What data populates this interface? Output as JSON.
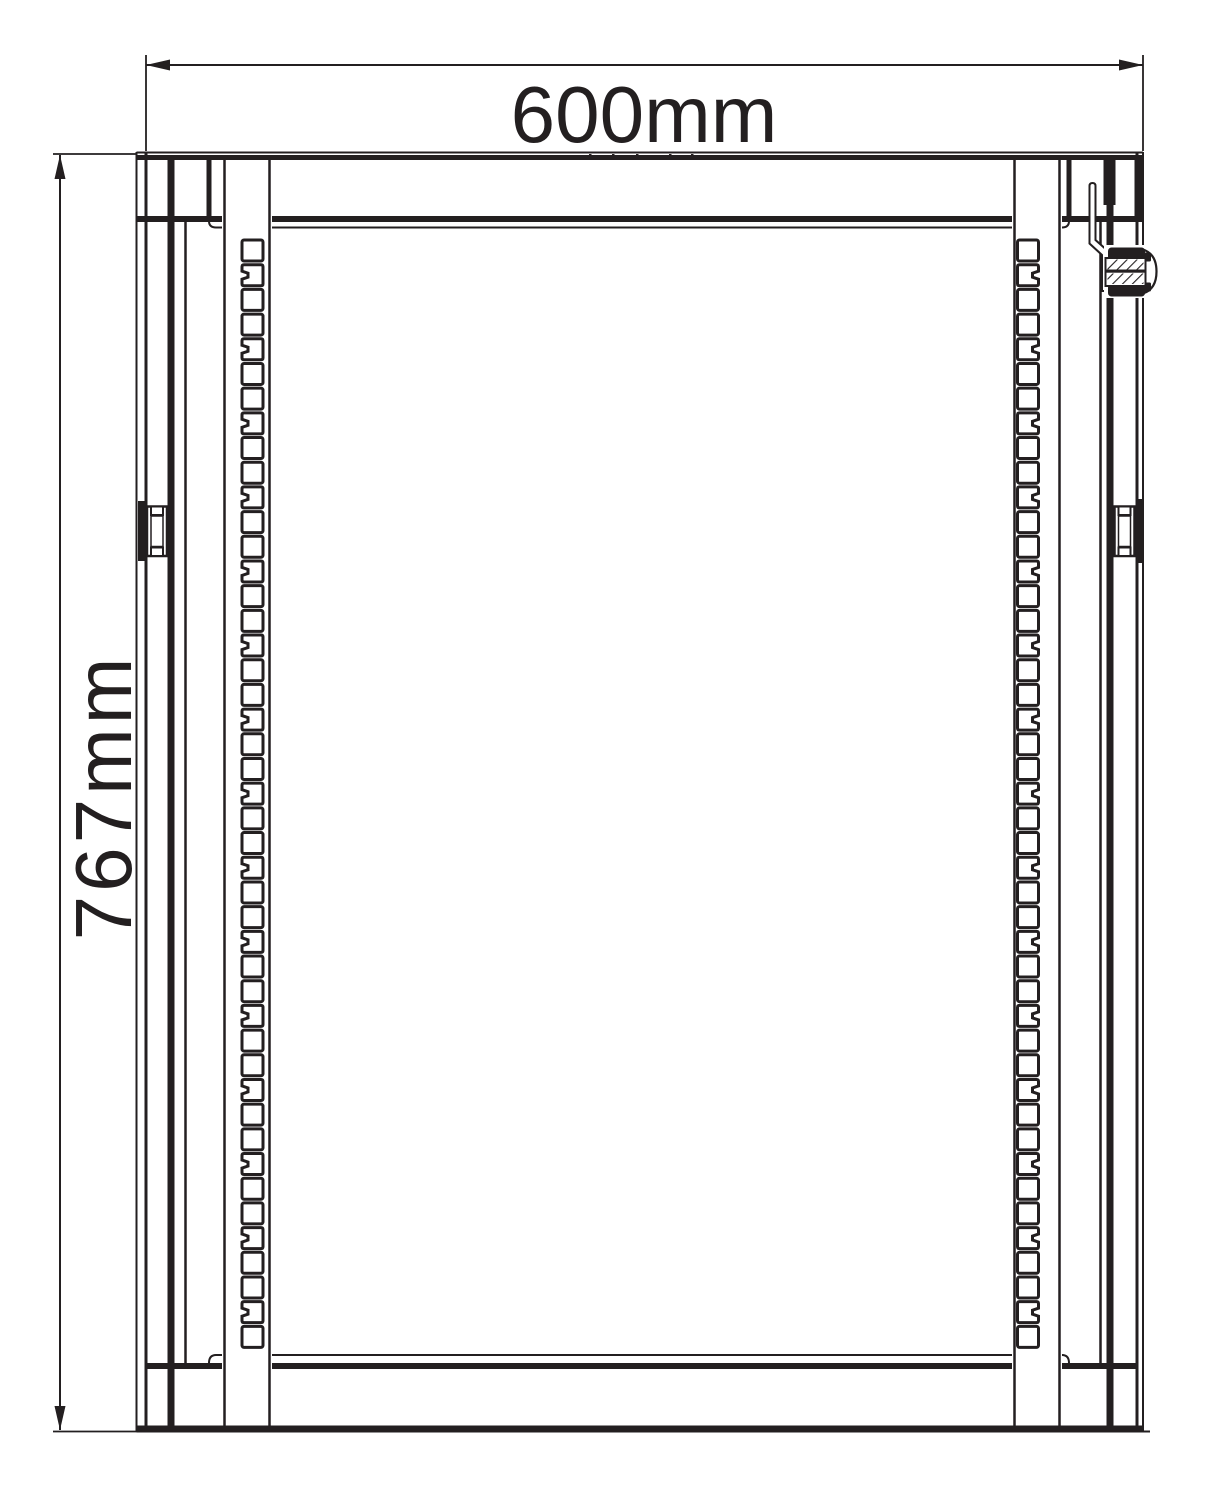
{
  "labels": {
    "width_dimension": "600mm",
    "height_dimension": "767mm"
  },
  "style": {
    "ink": "#231f20",
    "background": "#ffffff"
  },
  "drawing": {
    "type": "technical-front-view",
    "rails": {
      "holes_per_rail": 45,
      "group_size": 3,
      "notched_index_in_group": 2,
      "first_hole_top": 240,
      "pitch": 24.69,
      "hole_size": 21,
      "left_hole_x": 242,
      "right_hole_x": 1017.5,
      "hole_stroke": 3
    }
  }
}
